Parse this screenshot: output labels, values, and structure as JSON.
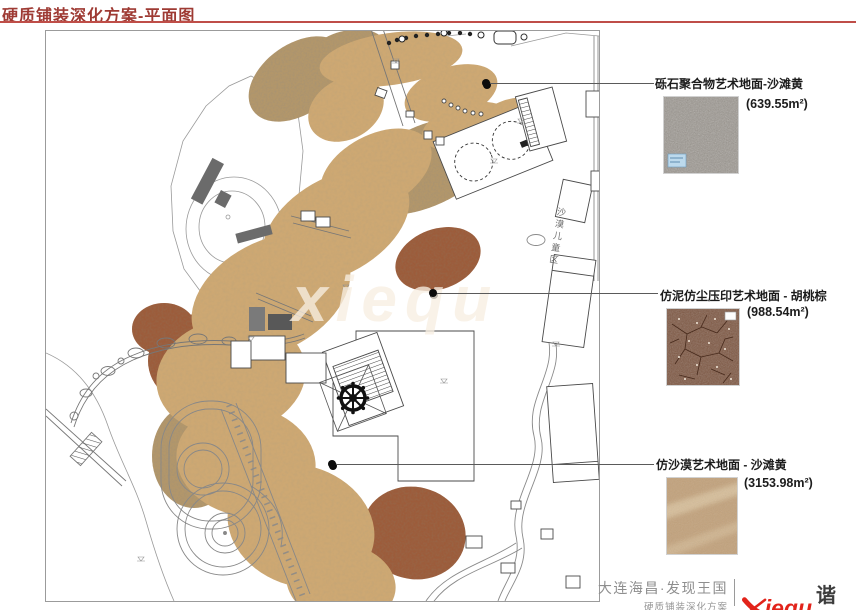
{
  "header": {
    "title": "硬质铺装深化方案-平面图"
  },
  "plan": {
    "area_tag": "沙漠儿童区",
    "watermark": "xiequ"
  },
  "callouts": [
    {
      "label": "砾石聚合物艺术地面-沙滩黄",
      "area": "(639.55m²)",
      "swatch": "gravel-aggregate-sand-yellow"
    },
    {
      "label": "仿泥仿尘压印艺术地面 - 胡桃棕",
      "area": "(988.54m²)",
      "swatch": "stamped-mud-walnut-brown"
    },
    {
      "label": "仿沙漠艺术地面 - 沙滩黄",
      "area": "(3153.98m²)",
      "swatch": "desert-art-sand-yellow"
    }
  ],
  "footer": {
    "project": "大连海昌·发现王国",
    "subtitle": "硬质铺装深化方案",
    "logo": {
      "x": "X",
      "rest": "iequ",
      "cn": "谐趣"
    }
  },
  "colors": {
    "title_red": "#9e3a33",
    "rule_red": "#bf4e48",
    "sand_paving": "#cda873",
    "walnut_paving": "#9d5c3b",
    "gravel_paving": "#b3976b",
    "logo_red": "#e2231a",
    "swatch_gravel": "#98928a",
    "swatch_mud": "#7f5843",
    "swatch_sand": "#c2a27c"
  }
}
